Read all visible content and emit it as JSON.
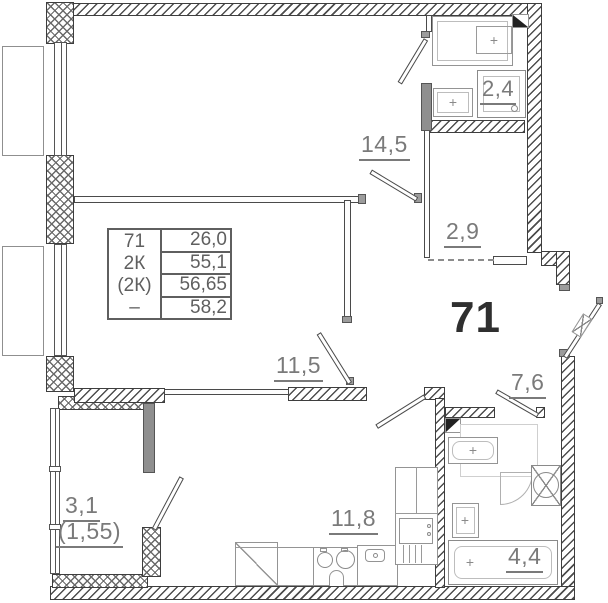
{
  "plan": {
    "apartment_number": "71",
    "info_table": {
      "col_left": [
        "71",
        "2К",
        "(2К)",
        "–"
      ],
      "col_right": [
        "26,0",
        "55,1",
        "56,65",
        "58,2"
      ]
    },
    "rooms": [
      {
        "name": "bedroom",
        "area": "14,5"
      },
      {
        "name": "living-room",
        "area": "11,5"
      },
      {
        "name": "kitchen",
        "area": "11,8"
      },
      {
        "name": "bathroom-top",
        "area": "2,4"
      },
      {
        "name": "storage",
        "area": "2,9"
      },
      {
        "name": "hallway",
        "area": "7,6"
      },
      {
        "name": "bathroom-bottom",
        "area": "4,4"
      },
      {
        "name": "balcony",
        "area": "3,1",
        "area_reduced": "(1,55)"
      }
    ],
    "icons": {
      "fixture_cross": "+"
    },
    "colors": {
      "wall_line": "#3e3e3e",
      "fixture_line": "#949494",
      "label": "#7a7a7a",
      "number": "#2f2f2f"
    }
  }
}
